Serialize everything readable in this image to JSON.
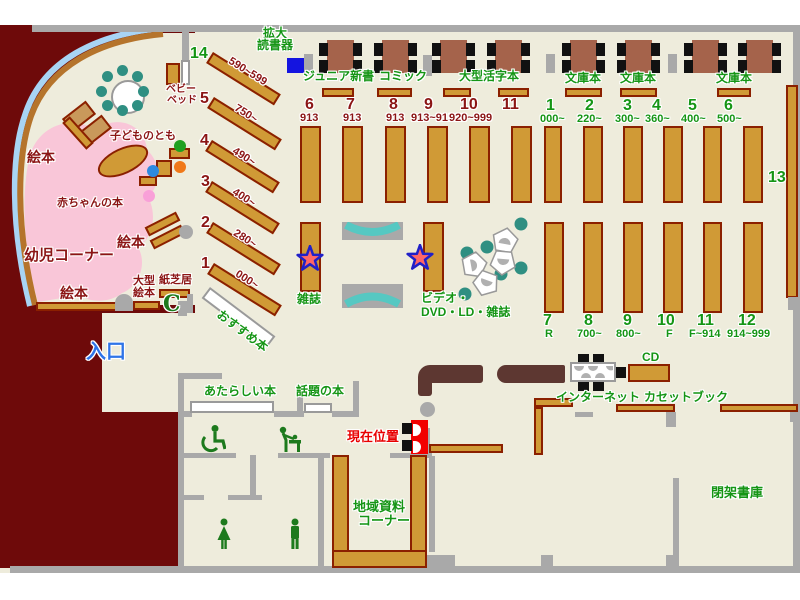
{
  "labels": {
    "kakudai1": "拡大",
    "kakudai2": "読書器",
    "junior": "ジュニア新書",
    "comic": "コミック",
    "large_print": "大型活字本",
    "bunko1": "文庫本",
    "bunko2": "文庫本",
    "bunko3": "文庫本",
    "baby_bed1": "ベビー",
    "baby_bed2": "ベッド",
    "kodomo": "子どものとも",
    "ehon1": "絵本",
    "ehon2": "絵本",
    "ehon3": "絵本",
    "akachan": "赤ちゃんの本",
    "yoji": "幼児コーナー",
    "ogata1": "大型",
    "ogata2": "絵本",
    "kamishibai": "紙芝居",
    "osusume": "おすすめ本",
    "zasshi": "雑誌",
    "video1": "ビデオ・",
    "video2": "DVD・LD・雑誌",
    "iriguchi": "入口",
    "atarashii": "あたらしい本",
    "wadai": "話題の本",
    "genzai": "現在位置",
    "chiiki1": "地域資料",
    "chiiki2": "コーナー",
    "internet": "インターネット",
    "cd": "CD",
    "cassette": "カセットブック",
    "heika": "閉架書庫",
    "n13": "13"
  },
  "children_shelves": [
    {
      "num": "14",
      "range": "590~599"
    },
    {
      "num": "5",
      "range": "750~"
    },
    {
      "num": "4",
      "range": "490~"
    },
    {
      "num": "3",
      "range": "400~"
    },
    {
      "num": "2",
      "range": "280~"
    },
    {
      "num": "1",
      "range": "000~"
    }
  ],
  "section_junior": [
    {
      "num": "6",
      "code": "913"
    },
    {
      "num": "7",
      "code": "913"
    },
    {
      "num": "8",
      "code": "913"
    },
    {
      "num": "9",
      "code": "913~919"
    },
    {
      "num": "10",
      "code": "920~999"
    },
    {
      "num": "11",
      "code": ""
    }
  ],
  "section_bunko": [
    {
      "num": "1",
      "code": "000~"
    },
    {
      "num": "2",
      "code": "220~"
    },
    {
      "num": "3",
      "code": "300~"
    },
    {
      "num": "4",
      "code": "360~"
    },
    {
      "num": "5",
      "code": "400~"
    },
    {
      "num": "6",
      "code": "500~"
    }
  ],
  "section_general": [
    {
      "num": "7",
      "code": "R"
    },
    {
      "num": "8",
      "code": "700~"
    },
    {
      "num": "9",
      "code": "800~"
    },
    {
      "num": "10",
      "code": "F"
    },
    {
      "num": "11",
      "code": "F~914"
    },
    {
      "num": "12",
      "code": "914~999"
    }
  ],
  "colors": {
    "floor": "#EEECDC",
    "outside": "#6E0A0A",
    "wall": "#A9A9A9",
    "shelf": "#D09A36",
    "shelf_border": "#8B2000",
    "label_green": "#159515",
    "label_dark_red": "#8B1515",
    "entrance_blue": "#2E74E8",
    "current_red": "#E80000",
    "infant_pink": "#F9C6D8",
    "glass_blue": "#A8D4F4",
    "chair_teal": "#2F8F82",
    "bench_teal": "#56C8C2",
    "counter_brown": "#5D3731",
    "table_brown": "#A5634B",
    "magnifier_blue": "#1414E0",
    "star_red": "#FF6666",
    "star_outline": "#2020C8"
  }
}
